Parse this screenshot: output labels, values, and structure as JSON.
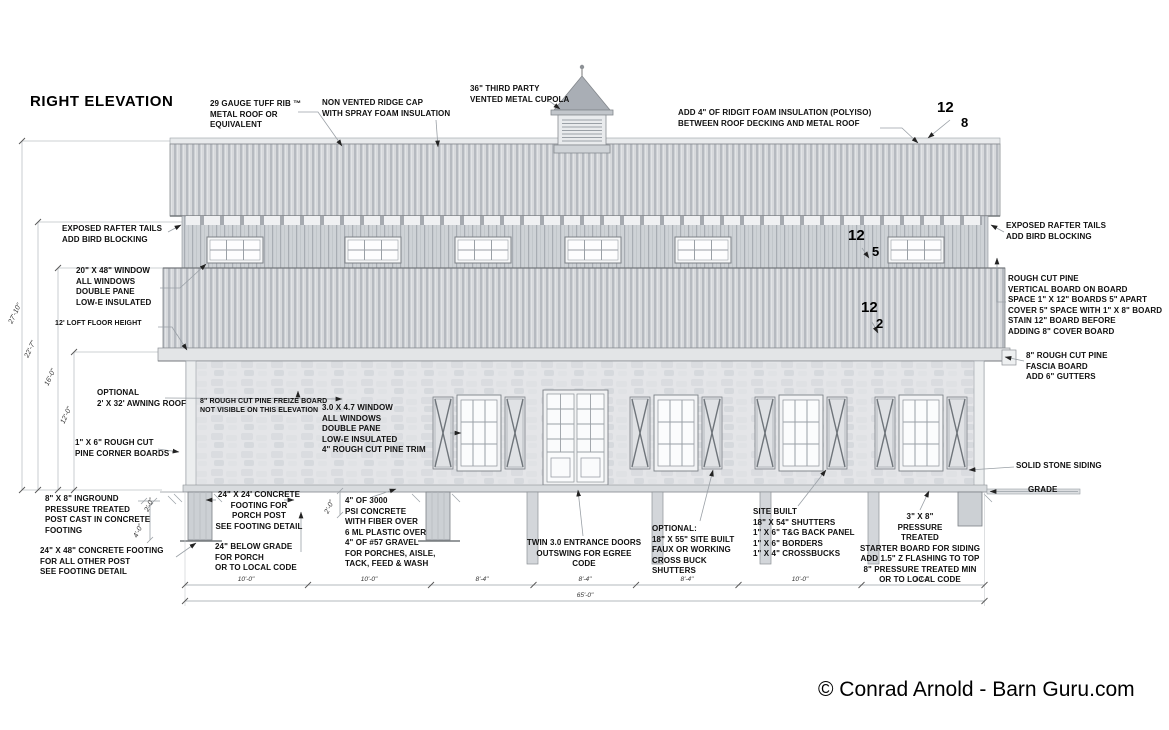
{
  "title": "RIGHT ELEVATION",
  "copyright": "© Conrad Arnold - Barn Guru.com",
  "notes": {
    "tuff_rib": "29 GAUGE TUFF RIB ™\nMETAL ROOF OR\nEQUIVALENT",
    "ridge_cap": "NON VENTED RIDGE CAP\nWITH SPRAY FOAM INSULATION",
    "cupola": "36\" THIRD PARTY\nVENTED METAL CUPOLA",
    "foam": "ADD 4\" OF RIDGIT FOAM INSULATION (POLYISO)\nBETWEEN ROOF DECKING AND METAL ROOF",
    "rafter_left": "EXPOSED RAFTER TAILS\nADD BIRD BLOCKING",
    "rafter_right": "EXPOSED RAFTER TAILS\nADD BIRD BLOCKING",
    "window_upper": "20\" X 48\" WINDOW\nALL WINDOWS\nDOUBLE PANE\nLOW-E INSULATED",
    "loft": "12' LOFT FLOOR HEIGHT",
    "board_on_board": "ROUGH CUT PINE\nVERTICAL BOARD ON BOARD\nSPACE 1\" X 12\" BOARDS  5\" APART\nCOVER 5\" SPACE WITH 1\" X 8\" BOARD\nSTAIN 12\" BOARD BEFORE\nADDING 8\" COVER BOARD",
    "fascia": "8\" ROUGH CUT PINE\nFASCIA BOARD\nADD 6\" GUTTERS",
    "awning": "OPTIONAL\n2' X 32' AWNING ROOF",
    "freize": "8\" ROUGH CUT PINE FREIZE BOARD\nNOT VISIBLE ON THIS ELEVATION",
    "window_lower": "3.0 X 4.7 WINDOW\nALL WINDOWS\nDOUBLE PANE\nLOW-E INSULATED\n4\" ROUGH CUT PINE TRIM",
    "corner_boards": "1\" X 6\" ROUGH CUT\nPINE CORNER BOARDS",
    "stone": "SOLID STONE SIDING",
    "grade": "GRADE",
    "post_inground": "8\" X 8\" INGROUND\nPRESSURE TREATED\nPOST CAST IN CONCRETE\nFOOTING",
    "footing_other": "24\" X 48\" CONCRETE FOOTING\nFOR ALL OTHER POST\nSEE FOOTING DETAIL",
    "footing_porch": "24\" X 24'  CONCRETE\nFOOTING FOR\nPORCH POST\nSEE FOOTING DETAIL",
    "below_grade": "24\" BELOW GRADE\nFOR PORCH\nOR TO LOCAL CODE",
    "concrete": "4\" OF 3000\nPSI CONCRETE\nWITH FIBER OVER\n6 ML PLASTIC OVER\n4\" OF #57 GRAVEL\nFOR PORCHES, AISLE,\nTACK, FEED & WASH",
    "doors": "TWIN 3.0 ENTRANCE DOORS\nOUTSWING FOR EGREE CODE",
    "shutters_optional": "OPTIONAL:\n18\" X 55\" SITE BUILT\nFAUX OR WORKING\nCROSS BUCK\nSHUTTERS",
    "shutters_site": "SITE BUILT\n18\" X 54\" SHUTTERS\n1\" X 6\" T&G BACK PANEL\n1\" X 6\" BORDERS\n1\" X 4\" CROSSBUCKS",
    "starter_board": "3\" X 8\"\nPRESSURE\nTREATED\nSTARTER BOARD FOR SIDING\nADD 1.5\" Z FLASHING TO TOP\n8\" PRESSURE TREATED  MIN\nOR TO LOCAL CODE"
  },
  "pitch_markers": [
    {
      "run": "12",
      "rise": "8"
    },
    {
      "run": "12",
      "rise": "5"
    },
    {
      "run": "12",
      "rise": "2"
    }
  ],
  "dimensions": {
    "left_vertical": [
      "27'-10\"",
      "22'-7\"",
      "16'-0\"",
      "12'-0\""
    ],
    "detail": [
      "2'-0\"",
      "4'-0\"",
      "2'-0\""
    ],
    "bottom_bays": [
      "10'-0\"",
      "10'-0\"",
      "8'-4\"",
      "8'-4\"",
      "8'-4\"",
      "10'-0\"",
      "10'-0\""
    ],
    "bottom_total": "65'-0\""
  },
  "colors": {
    "ink": "#101010",
    "metal_dark": "#b6bac0",
    "metal_light": "#d7d9dc",
    "stone": "#e4e5e8",
    "line": "#9aa0a6"
  }
}
